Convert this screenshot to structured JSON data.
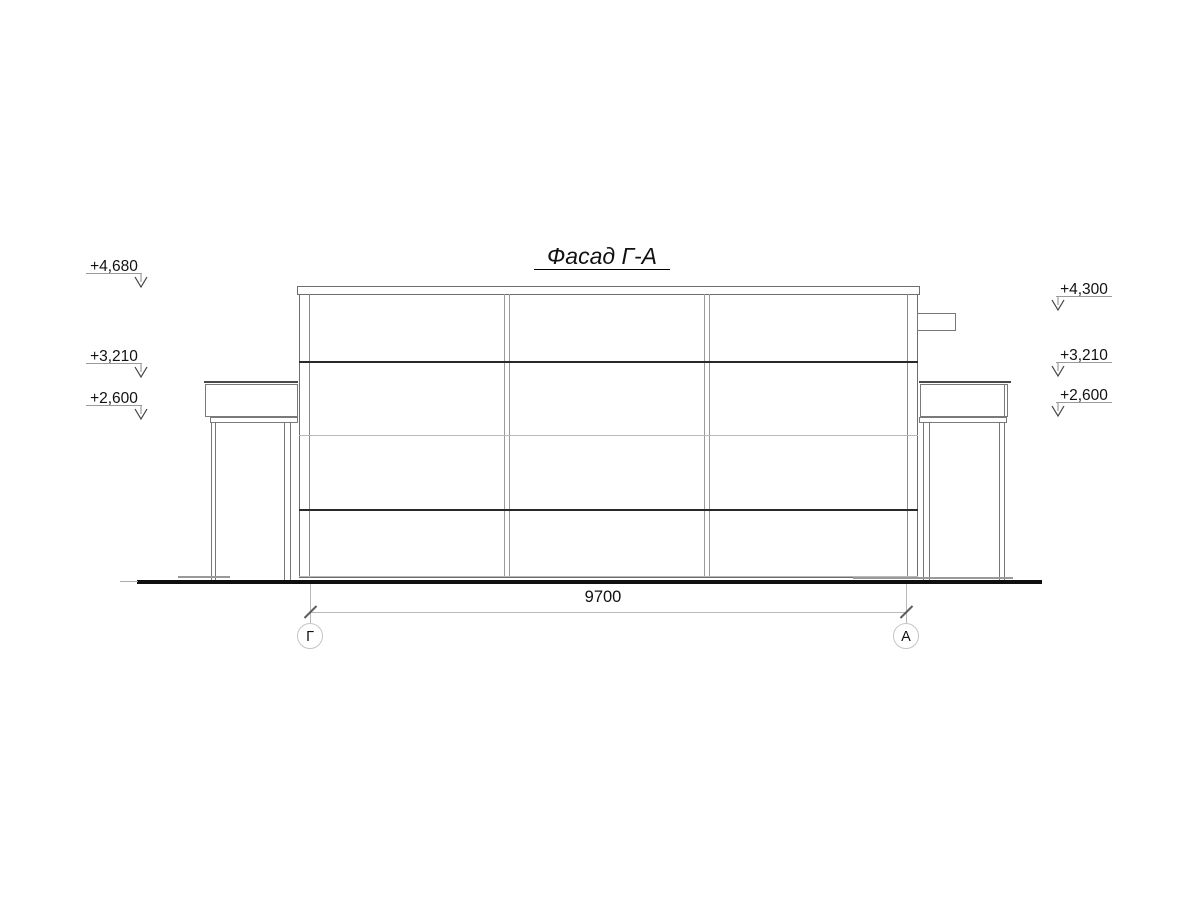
{
  "title": "Фасад Г-А",
  "dimension": {
    "length_label": "9700"
  },
  "axis_markers": {
    "left": "Г",
    "right": "А"
  },
  "elevation_marks": {
    "left": [
      {
        "value": "+4,680"
      },
      {
        "value": "+3,210"
      },
      {
        "value": "+2,600"
      }
    ],
    "right": [
      {
        "value": "+4,300"
      },
      {
        "value": "+3,210"
      },
      {
        "value": "+2,600"
      }
    ]
  },
  "colors": {
    "ink": "#111111",
    "outline_gray": "#6e6e6e",
    "light_line": "#b8b8b8"
  }
}
